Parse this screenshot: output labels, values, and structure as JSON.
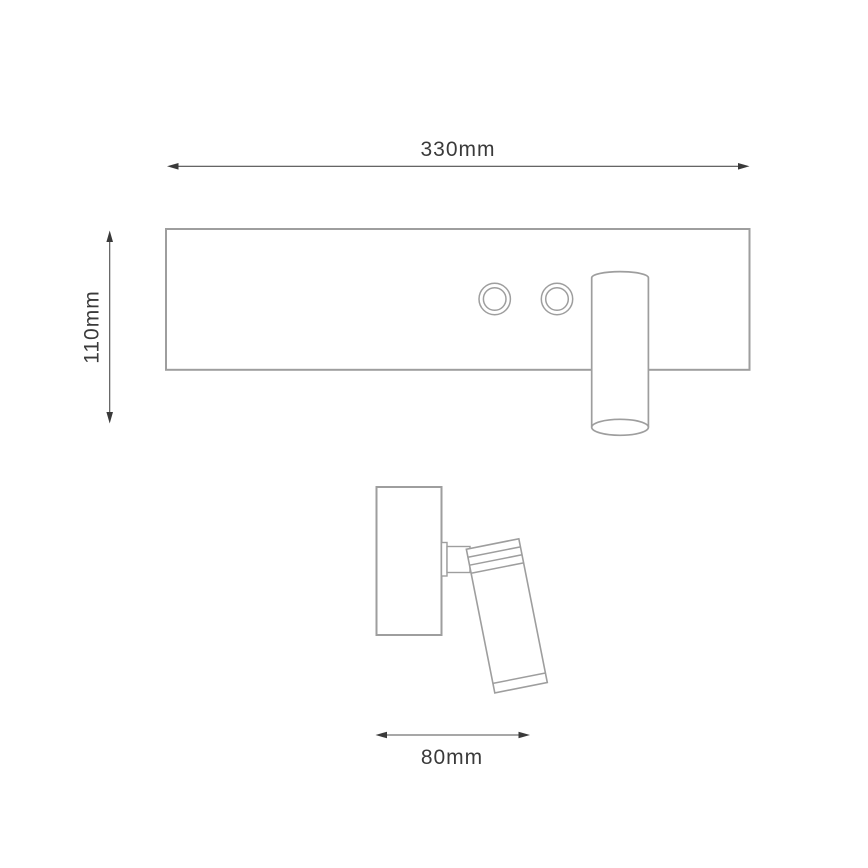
{
  "dimensions": {
    "width": {
      "label": "330mm"
    },
    "height": {
      "label": "110mm"
    },
    "depth": {
      "label": "80mm"
    }
  },
  "colors": {
    "outline": "#9e9e9e",
    "dimension_line": "#4f4f4f",
    "dimension_text": "#3a3a3a",
    "background": "#ffffff"
  }
}
